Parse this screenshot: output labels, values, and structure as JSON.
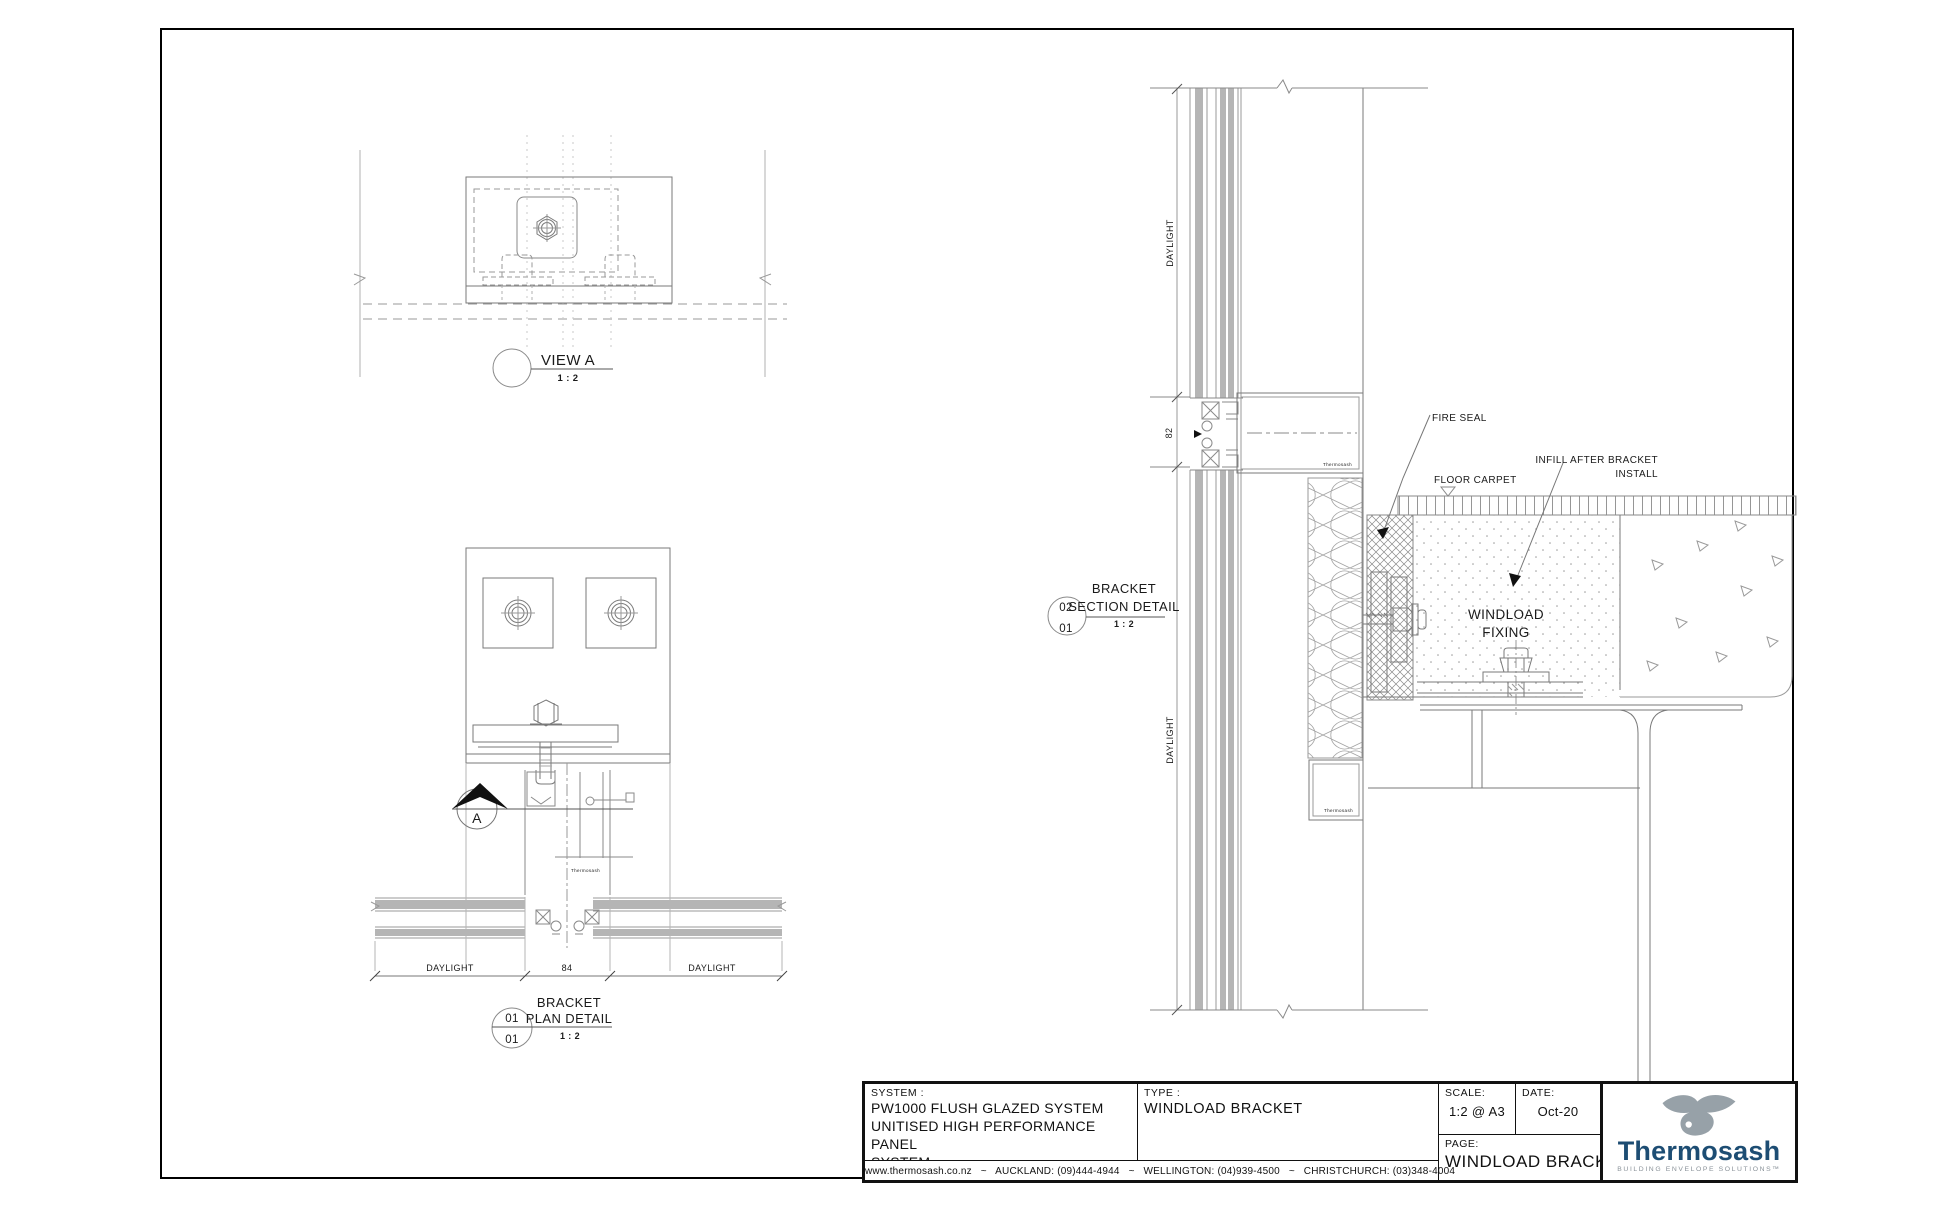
{
  "sheet": {
    "view_a": {
      "title": "VIEW A",
      "scale": "1 : 2"
    },
    "plan_detail": {
      "title_line1": "BRACKET",
      "title_line2": "PLAN DETAIL",
      "scale": "1 : 2",
      "ref_top": "01",
      "ref_bottom": "01",
      "section_marker": "A",
      "dim_left": "DAYLIGHT",
      "dim_center": "84",
      "dim_right": "DAYLIGHT",
      "brand_mark": "Thermosash"
    },
    "section_detail": {
      "title_line1": "BRACKET",
      "title_line2": "SECTION DETAIL",
      "scale": "1 : 2",
      "ref_top": "02",
      "ref_bottom": "01",
      "dim_top": "DAYLIGHT",
      "dim_joint": "82",
      "dim_bottom": "DAYLIGHT",
      "label_fire_seal": "FIRE SEAL",
      "label_floor_carpet": "FLOOR CARPET",
      "label_infill_1": "INFILL AFTER BRACKET",
      "label_infill_2": "INSTALL",
      "label_windload_1": "WINDLOAD",
      "label_windload_2": "FIXING",
      "brand_mark": "Thermosash"
    }
  },
  "title_block": {
    "system_label": "SYSTEM :",
    "system_line1": "PW1000 FLUSH GLAZED SYSTEM",
    "system_line2": "UNITISED HIGH PERFORMANCE PANEL",
    "system_line3": "SYSTEM",
    "type_label": "TYPE :",
    "type_value": "WINDLOAD BRACKET",
    "scale_label": "SCALE:",
    "scale_value": "1:2 @ A3",
    "date_label": "DATE:",
    "date_value": "Oct-20",
    "page_label": "PAGE:",
    "page_value": "WINDLOAD BRACKET",
    "contact_line": "www.thermosash.co.nz   ~   AUCKLAND: (09)444-4944   ~   WELLINGTON: (04)939-4500   ~   CHRISTCHURCH: (03)348-4004"
  },
  "logo": {
    "wordmark": "Thermosash",
    "tagline": "BUILDING ENVELOPE SOLUTIONS™",
    "colors": {
      "wordmark_blue": "#1d4d73",
      "bird_gray": "#97a1a8",
      "tagline_gray": "#8a9299"
    }
  }
}
